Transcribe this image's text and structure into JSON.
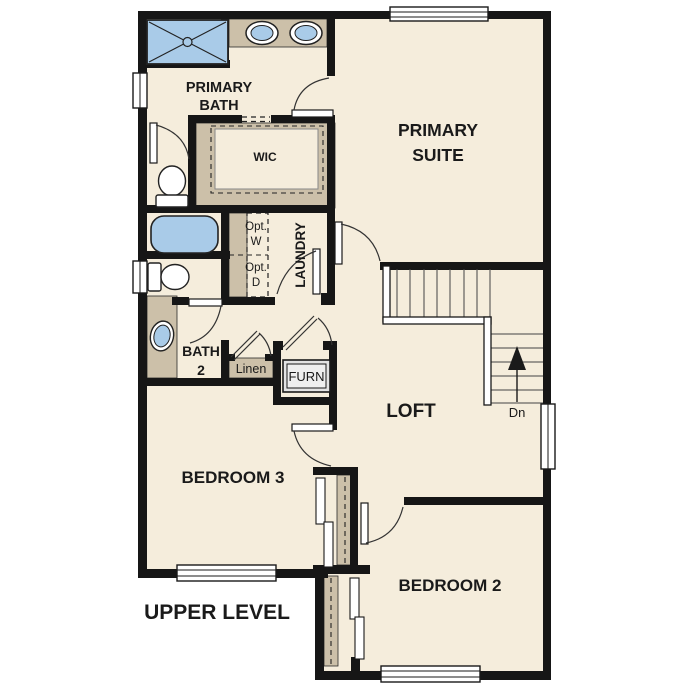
{
  "plan": {
    "title": "UPPER LEVEL",
    "rooms": {
      "primary_bath": {
        "line1": "PRIMARY",
        "line2": "BATH"
      },
      "primary_suite": {
        "line1": "PRIMARY",
        "line2": "SUITE"
      },
      "wic": {
        "label": "WIC"
      },
      "laundry": {
        "label": "LAUNDRY"
      },
      "opt_washer": {
        "line1": "Opt.",
        "line2": "W"
      },
      "opt_dryer": {
        "line1": "Opt.",
        "line2": "D"
      },
      "bath_2": {
        "line1": "BATH",
        "line2": "2"
      },
      "linen": {
        "label": "Linen"
      },
      "furnace": {
        "label": "FURN"
      },
      "loft": {
        "label": "LOFT"
      },
      "bedroom_3": {
        "label": "BEDROOM 3"
      },
      "bedroom_2": {
        "label": "BEDROOM 2"
      }
    },
    "stairs": {
      "direction_label": "Dn"
    },
    "colors": {
      "floor": "#f5eddc",
      "wall": "#161616",
      "cabinetry": "#ccc0a9",
      "fixtures": "#a9cbe8",
      "appliance": "#e4e4e4",
      "text": "#1a1a1a"
    }
  }
}
